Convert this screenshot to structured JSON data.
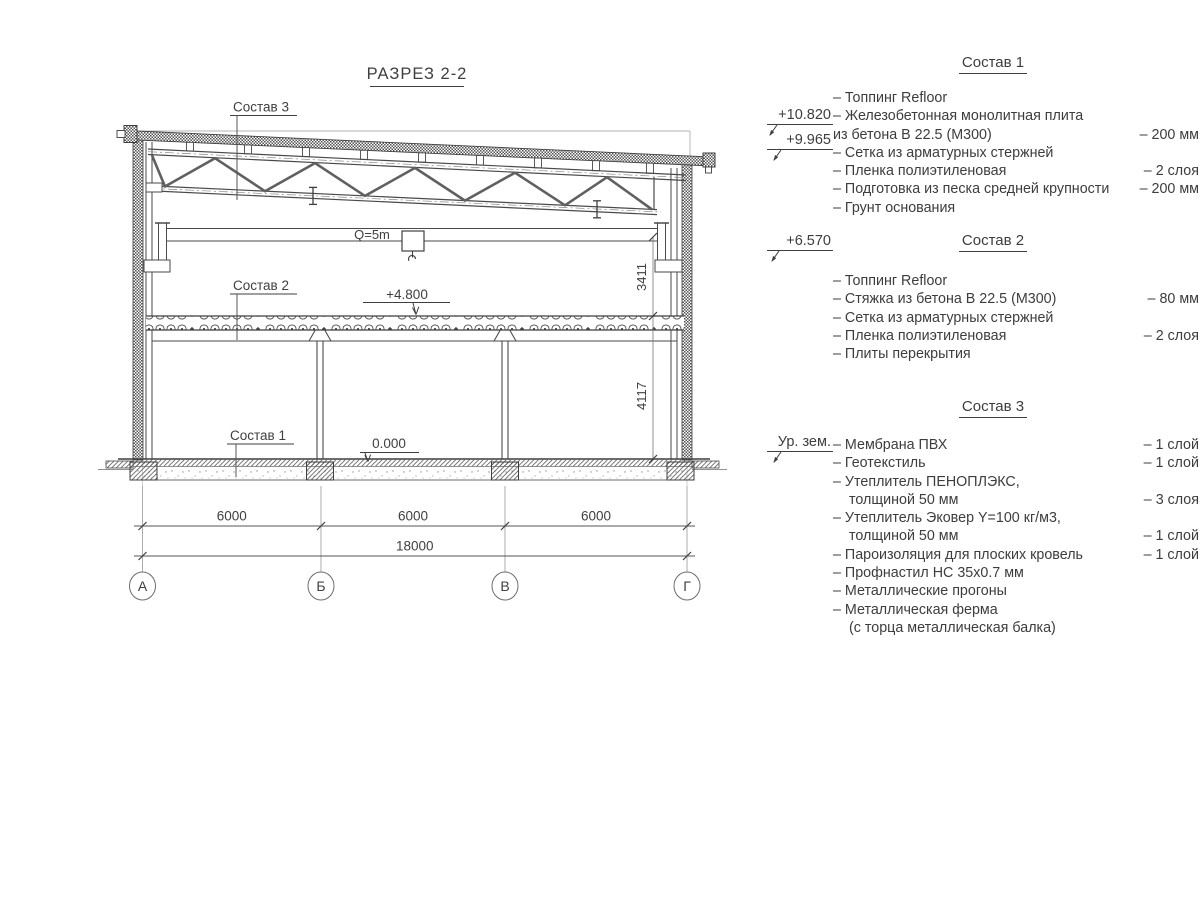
{
  "drawing": {
    "title": "РАЗРЕЗ 2-2",
    "callouts": {
      "sostav1": "Состав 1",
      "sostav2": "Состав 2",
      "sostav3": "Состав 3"
    },
    "crane_label": "Q=5m",
    "elevations": {
      "plus4800": "+4.800",
      "zero": "0.000"
    },
    "dims": {
      "v1": "3411",
      "v2": "4117",
      "bay": "6000",
      "total": "18000"
    },
    "axes": [
      "А",
      "Б",
      "В",
      "Г"
    ]
  },
  "legend": {
    "markers": [
      {
        "label": "+10.820"
      },
      {
        "label": "+9.965"
      },
      {
        "label": "+6.570"
      },
      {
        "label": "Ур. зем."
      }
    ],
    "sections": [
      {
        "title": "Состав 1",
        "items": [
          {
            "text": "– Топпинг Refloor",
            "value": ""
          },
          {
            "text": "– Железобетонная монолитная плита",
            "value": ""
          },
          {
            "text": "из бетона В 22.5 (М300)",
            "value": "– 200 мм"
          },
          {
            "text": "– Сетка из арматурных стержней",
            "value": ""
          },
          {
            "text": "– Пленка полиэтиленовая",
            "value": "– 2 слоя"
          },
          {
            "text": "– Подготовка из песка средней крупности",
            "value": "– 200 мм"
          },
          {
            "text": "– Грунт основания",
            "value": ""
          }
        ]
      },
      {
        "title": "Состав 2",
        "items": [
          {
            "text": "– Топпинг Refloor",
            "value": ""
          },
          {
            "text": "– Стяжка из бетона В 22.5 (М300)",
            "value": "– 80 мм"
          },
          {
            "text": "– Сетка из арматурных стержней",
            "value": ""
          },
          {
            "text": "– Пленка полиэтиленовая",
            "value": "– 2 слоя"
          },
          {
            "text": "– Плиты перекрытия",
            "value": ""
          }
        ]
      },
      {
        "title": "Состав 3",
        "items": [
          {
            "text": "– Мембрана ПВХ",
            "value": "– 1 слой"
          },
          {
            "text": "– Геотекстиль",
            "value": "– 1 слой"
          },
          {
            "text": "– Утеплитель ПЕНОПЛЭКС,",
            "value": ""
          },
          {
            "text": "толщиной 50 мм",
            "value": "– 3 слоя"
          },
          {
            "text": "– Утеплитель Эковер Y=100 кг/м3,",
            "value": ""
          },
          {
            "text": "толщиной 50 мм",
            "value": "– 1 слой"
          },
          {
            "text": "– Пароизоляция для плоских кровель",
            "value": "– 1 слой"
          },
          {
            "text": "– Профнастил НС 35х0.7 мм",
            "value": ""
          },
          {
            "text": "– Металлические прогоны",
            "value": ""
          },
          {
            "text": "– Металлическая ферма",
            "value": ""
          },
          {
            "text": "(с торца металлическая балка)",
            "value": ""
          }
        ]
      }
    ]
  }
}
